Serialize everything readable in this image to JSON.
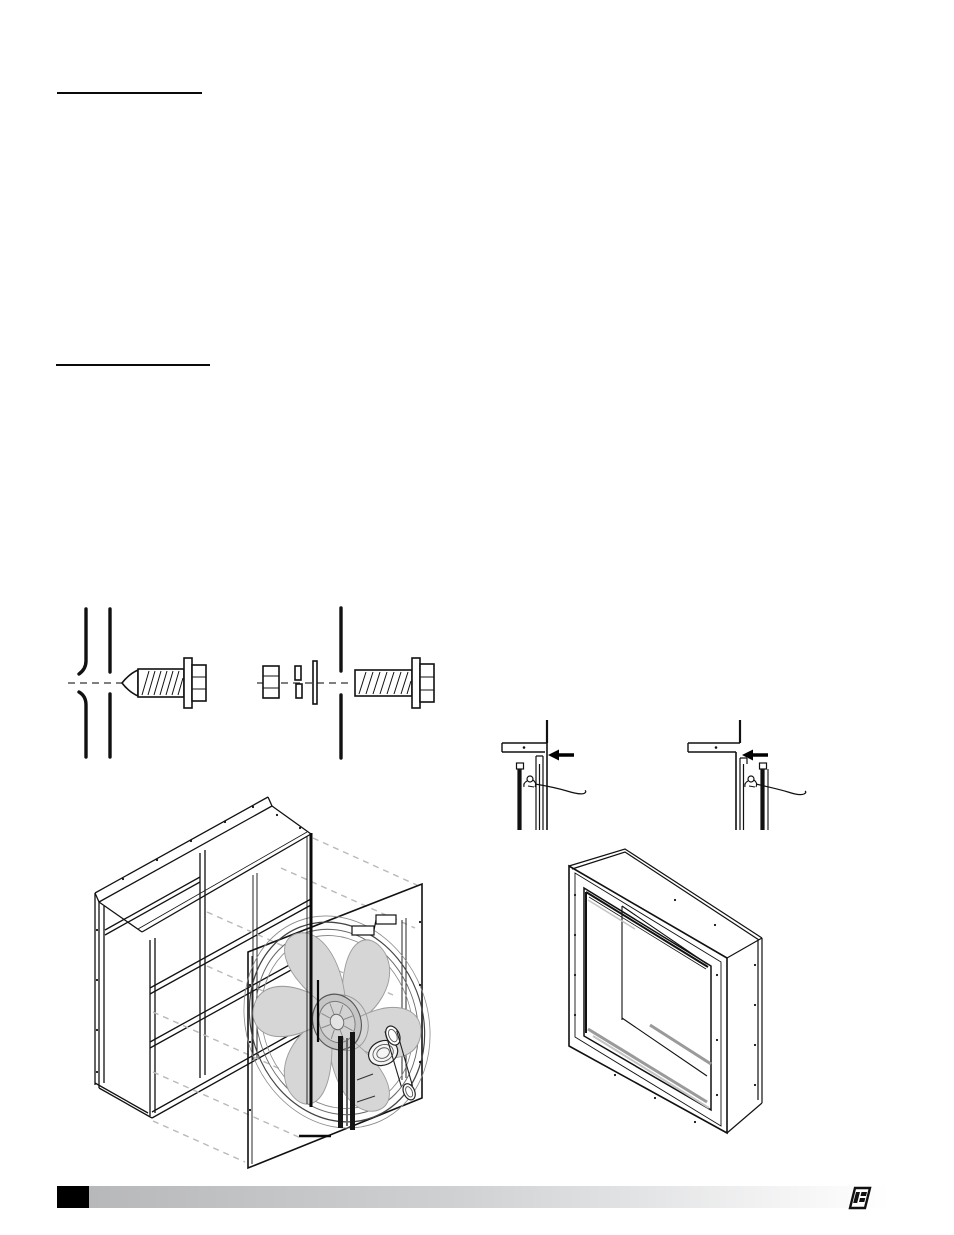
{
  "document": {
    "kind": "technical-manual-page",
    "visible_text": ""
  },
  "colors": {
    "ink": "#111111",
    "blade_fill": "#d6d6d6",
    "blade_line": "#9c9c9c",
    "dashed_projection": "#b9b9b9",
    "interior_shade": "#9a9a9a",
    "footer_bar_left": "#b7b8ba",
    "footer_bar_right": "#ffffff",
    "footer_block": "#000000",
    "paper": "#ffffff"
  },
  "heading_rules": [
    {
      "id": "rule-1"
    },
    {
      "id": "rule-2"
    }
  ],
  "figures": {
    "fastener_diagram_1": "self-drilling-screw-through-two-panels",
    "fastener_diagram_2": "hex-bolt-flat-washer-lock-washer-nut-through-panel",
    "detail_a": "panel-corner-joint-clip-detail-left",
    "detail_b": "panel-corner-joint-clip-detail-right",
    "exploded_view": "fan-panel-sliding-into-wall-housing-exploded-isometric",
    "housing_view": "empty-wall-housing-isometric"
  },
  "footer": {
    "page_block_text": "",
    "logo": "brand-logo-mark"
  }
}
